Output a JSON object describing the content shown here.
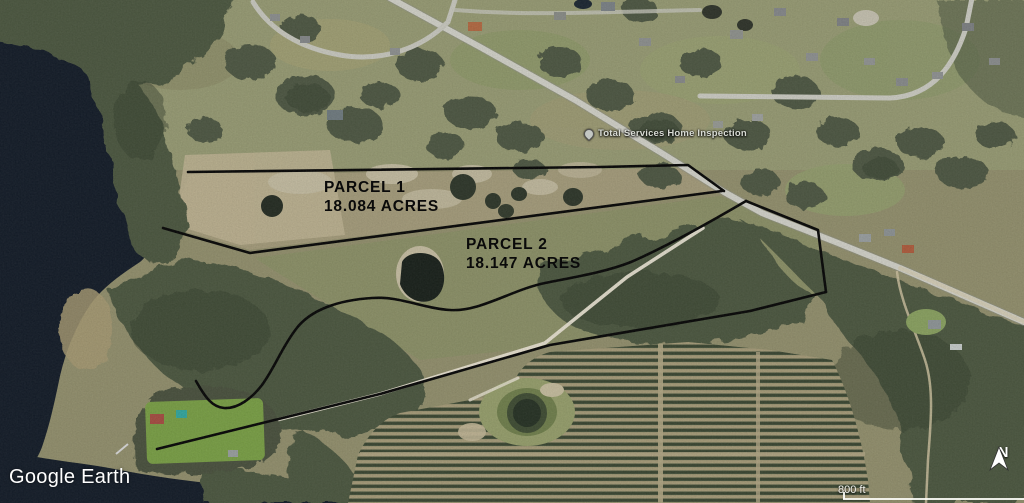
{
  "app": {
    "watermark": "Google Earth"
  },
  "annotations": {
    "parcel1": {
      "name": "PARCEL 1",
      "acreage": "18.084 ACRES"
    },
    "parcel2": {
      "name": "PARCEL 2",
      "acreage": "18.147 ACRES"
    }
  },
  "poi": {
    "label": "Total Services Home Inspection"
  },
  "map_controls": {
    "north_label": "N",
    "scale_label": "800 ft"
  },
  "colors": {
    "boundary_line": "#000000",
    "water": "#0e1724",
    "overlay_text": "#ffffff",
    "land_parcel1": "#a69d7b",
    "land_parcel2": "#8c9166",
    "forest": "#4a543e",
    "grove_row": "#45523a",
    "road": "#d6d6cd"
  }
}
